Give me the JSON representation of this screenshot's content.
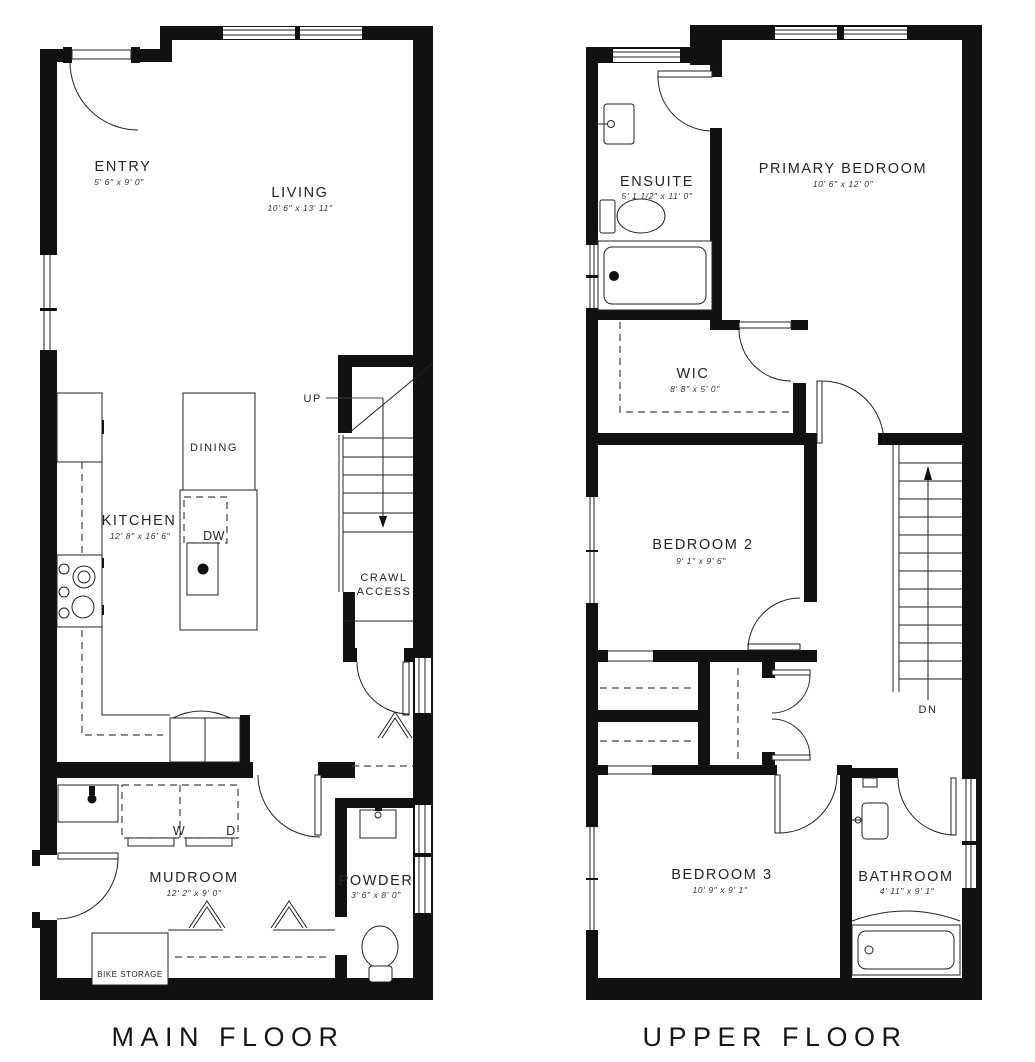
{
  "drawing": {
    "type": "residential floor plan, two panels",
    "wall_color": "#111111",
    "background": "#ffffff"
  },
  "floors": [
    {
      "title": "MAIN FLOOR",
      "rooms": [
        {
          "name": "ENTRY",
          "dims": "5' 6\" x 9' 0\""
        },
        {
          "name": "LIVING",
          "dims": "10' 6\" x 13' 11\""
        },
        {
          "name": "DINING",
          "dims": ""
        },
        {
          "name": "KITCHEN",
          "dims": "12' 8\" x 16' 6\""
        },
        {
          "name": "MUDROOM",
          "dims": "12' 2\" x 9' 0\""
        },
        {
          "name": "POWDER",
          "dims": "3' 6\" x 8' 0\""
        }
      ],
      "labels": {
        "up": "UP",
        "dw": "DW",
        "washer": "W",
        "dryer": "D",
        "crawl_line1": "CRAWL",
        "crawl_line2": "ACCESS",
        "bike_storage": "BIKE STORAGE"
      }
    },
    {
      "title": "UPPER FLOOR",
      "rooms": [
        {
          "name": "ENSUITE",
          "dims": "5' 1 1/2\" x 11' 0\""
        },
        {
          "name": "PRIMARY BEDROOM",
          "dims": "10' 6\" x 12' 0\""
        },
        {
          "name": "WIC",
          "dims": "8' 8\" x 5' 0\""
        },
        {
          "name": "BEDROOM 2",
          "dims": "9' 1\" x 9' 6\""
        },
        {
          "name": "BEDROOM 3",
          "dims": "10' 9\" x 9' 1\""
        },
        {
          "name": "BATHROOM",
          "dims": "4' 11\" x 9' 1\""
        }
      ],
      "labels": {
        "dn": "DN"
      }
    }
  ]
}
